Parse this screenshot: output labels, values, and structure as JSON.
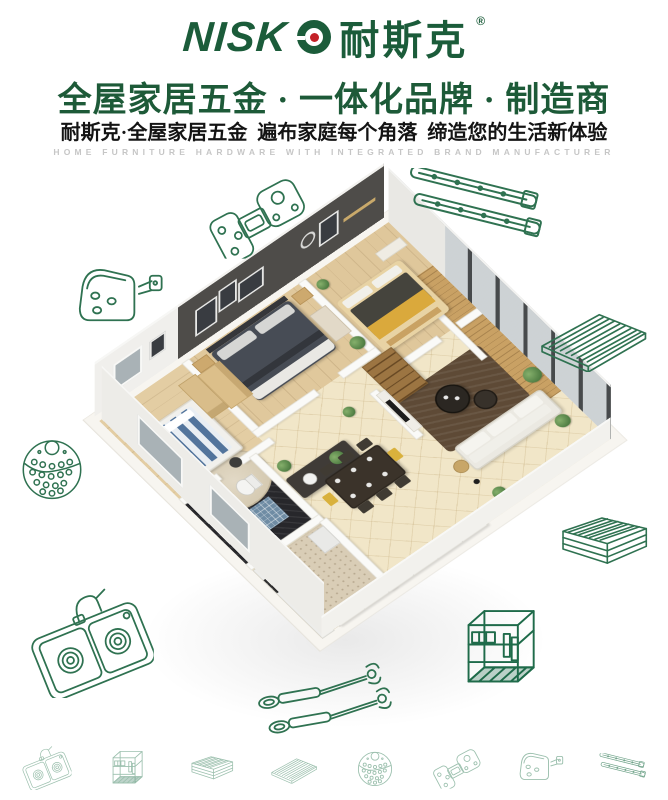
{
  "brand": {
    "logo_latin": "NISKO",
    "logo_text_latin": "NISK",
    "logo_cn": "耐斯克",
    "registered_mark": "®"
  },
  "header": {
    "headline": "全屋家居五金 · 一体化品牌 · 制造商",
    "subheadline": "耐斯克·全屋家居五金  遍布家庭每个角落  缔造您的生活新体验",
    "caption_en": "HOME FURNITURE HARDWARE WITH INTEGRATED BRAND MANUFACTURER"
  },
  "palette": {
    "brand_green": "#1b5c3a",
    "headline_green": "#1d5a38",
    "logo_dot_red": "#c42127",
    "icon_line_green": "#2f7251",
    "icon_line_green_dark": "#1f6b4a",
    "icon_line_green_faded": "#9cc0ae"
  },
  "hero": {
    "type": "3d-isometric-apartment-cutaway-render"
  },
  "hardware_icons": {
    "large": [
      "concealed-hinge-icon",
      "corner-bracket-icon",
      "drawer-slide-icon",
      "wire-shelf-icon",
      "round-basket-icon",
      "wire-basket-icon",
      "double-sink-icon",
      "gas-strut-icon",
      "wire-organizer-icon"
    ],
    "footer": [
      "double-sink-icon",
      "wire-organizer-icon",
      "wire-basket-icon",
      "wire-shelf-icon",
      "round-basket-icon",
      "concealed-hinge-icon",
      "corner-bracket-icon",
      "drawer-slide-icon"
    ]
  }
}
